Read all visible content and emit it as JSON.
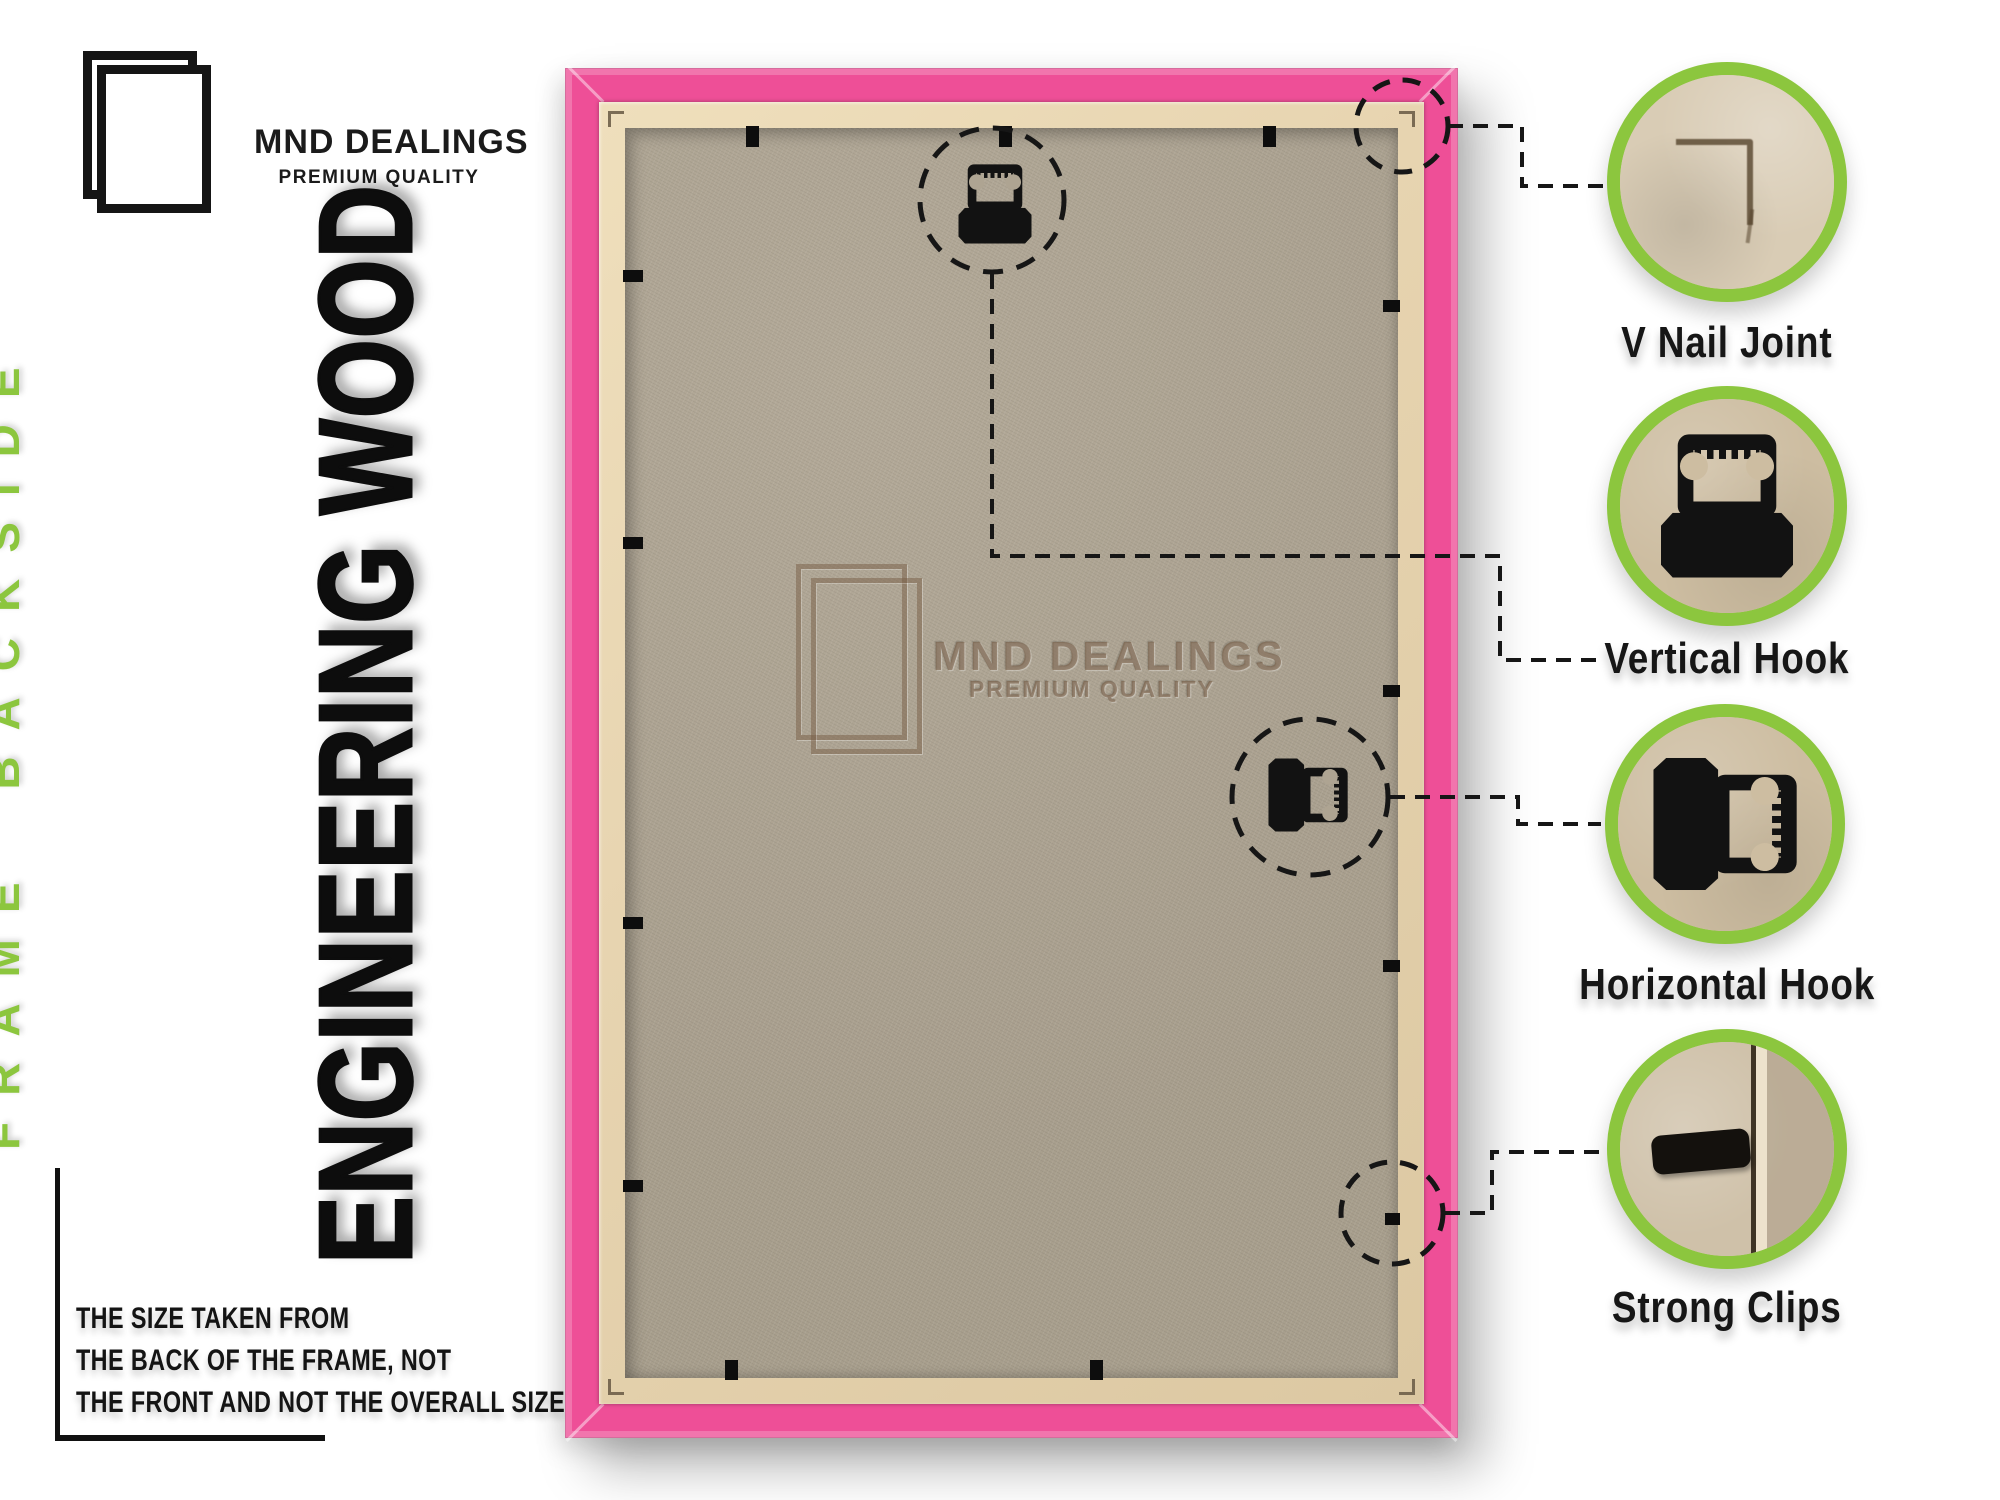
{
  "brand": {
    "name": "MND DEALINGS",
    "tagline": "PREMIUM QUALITY"
  },
  "side_label": "FRAME BACKSIDE",
  "material_label": "ENGINEERING WOOD",
  "note": [
    "THE SIZE TAKEN FROM",
    "THE BACK OF THE FRAME, NOT",
    "THE FRONT AND NOT THE OVERALL SIZE."
  ],
  "watermark": {
    "name": "MND DEALINGS",
    "tagline": "PREMIUM QUALITY"
  },
  "callouts": [
    {
      "id": "v-nail-joint",
      "label": "V Nail Joint"
    },
    {
      "id": "vertical-hook",
      "label": "Vertical Hook"
    },
    {
      "id": "horizontal-hook",
      "label": "Horizontal Hook"
    },
    {
      "id": "strong-clips",
      "label": "Strong Clips"
    }
  ],
  "colors": {
    "frame_pink": "#EE4F97",
    "accent_green": "#8CC63E",
    "wood_lip": "#E7D4B0",
    "board": "#AFA593",
    "label_black": "#161616"
  }
}
